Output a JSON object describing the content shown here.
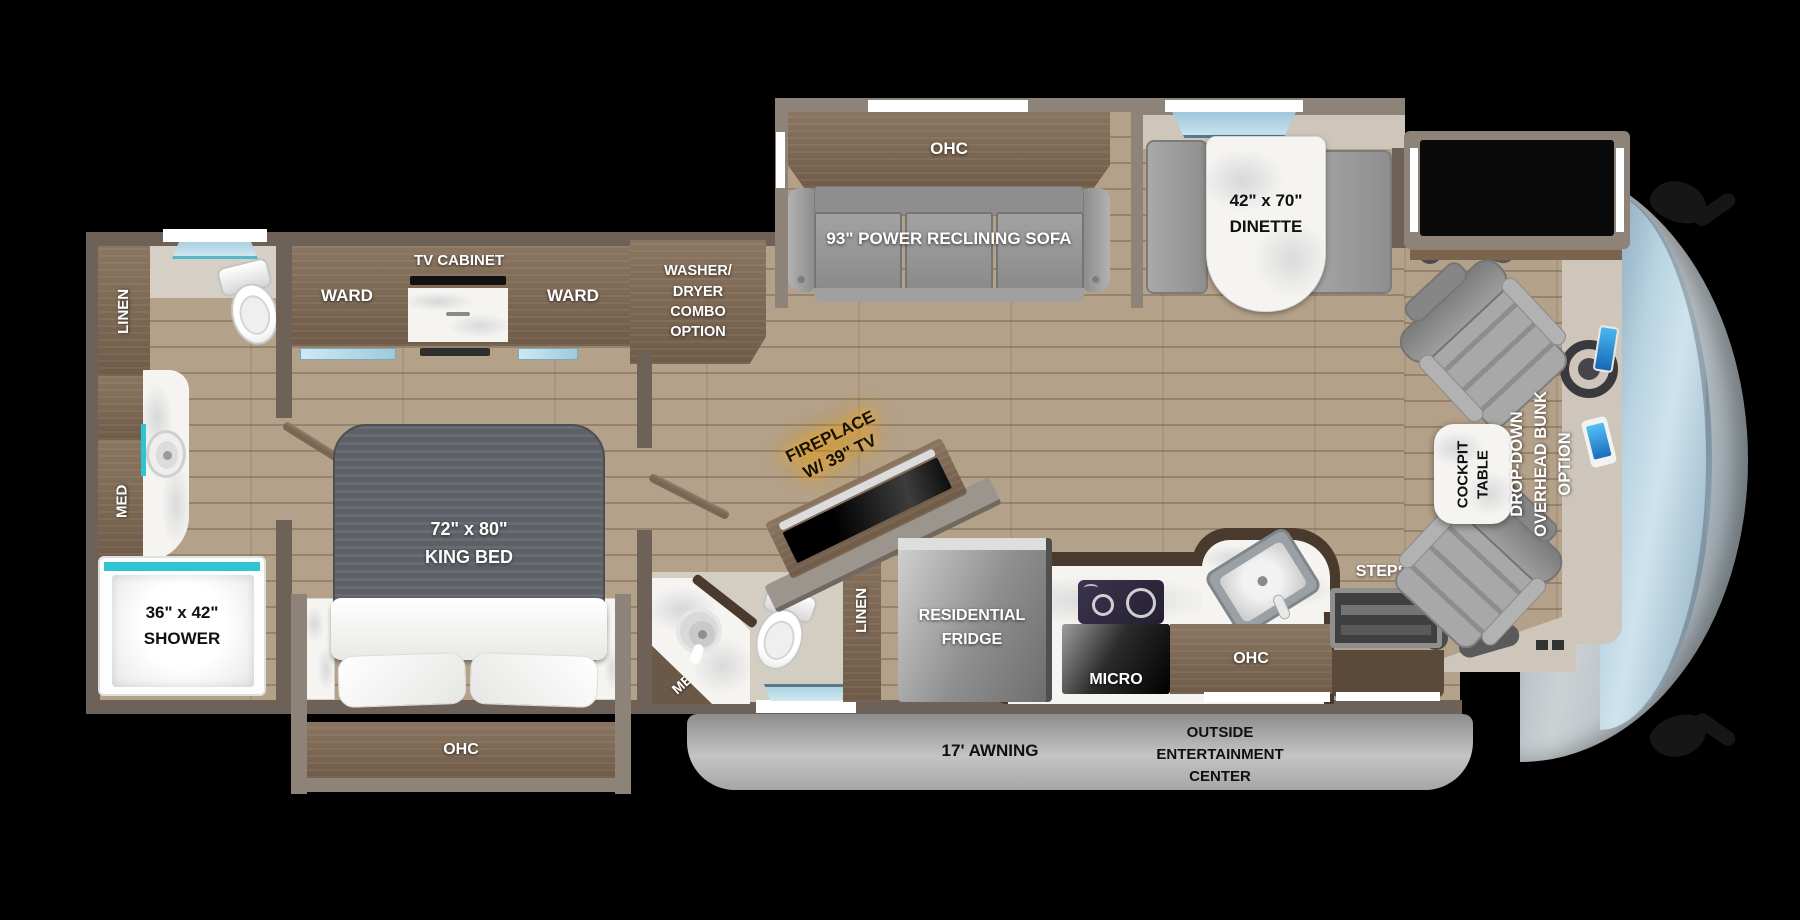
{
  "floorplan": {
    "living": {
      "ohc": "OHC",
      "sofa": "93\" POWER RECLINING SOFA",
      "dinette_size": "42\" x 70\"",
      "dinette_name": "DINETTE"
    },
    "bedroom": {
      "ward_left": "WARD",
      "tv_cabinet": "TV CABINET",
      "ward_right": "WARD",
      "washer_dryer": "WASHER/\nDRYER\nCOMBO\nOPTION",
      "bed_size": "72\" x 80\"",
      "bed_name": "KING BED",
      "ohc_under_bed": "OHC"
    },
    "rear_bath": {
      "linen": "LINEN",
      "med": "MED",
      "shower_size": "36\" x 42\"",
      "shower_name": "SHOWER"
    },
    "mid_bath": {
      "med": "MED",
      "linen": "LINEN"
    },
    "kitchen": {
      "fridge_line1": "RESIDENTIAL",
      "fridge_line2": "FRIDGE",
      "micro": "MICRO",
      "ohc": "OHC"
    },
    "entry": {
      "steps": "STEPS"
    },
    "fireplace": {
      "line1": "FIREPLACE",
      "line2": "W/ 39\" TV"
    },
    "cockpit": {
      "table_line1": "COCKPIT",
      "table_line2": "TABLE",
      "bunk_line1": "DROP-DOWN",
      "bunk_line2": "OVERHEAD BUNK",
      "bunk_line3": "OPTION"
    },
    "exterior": {
      "awning": "17' AWNING",
      "entertainment_line1": "OUTSIDE",
      "entertainment_line2": "ENTERTAINMENT",
      "entertainment_line3": "CENTER"
    }
  },
  "colors": {
    "teal_accent": "#2fc4d2",
    "fireplace_glow": "#ffa928",
    "wall": "#6e6258",
    "cabinet_wood": "#7f6b56",
    "awning_gray": "#9c9c9c"
  }
}
